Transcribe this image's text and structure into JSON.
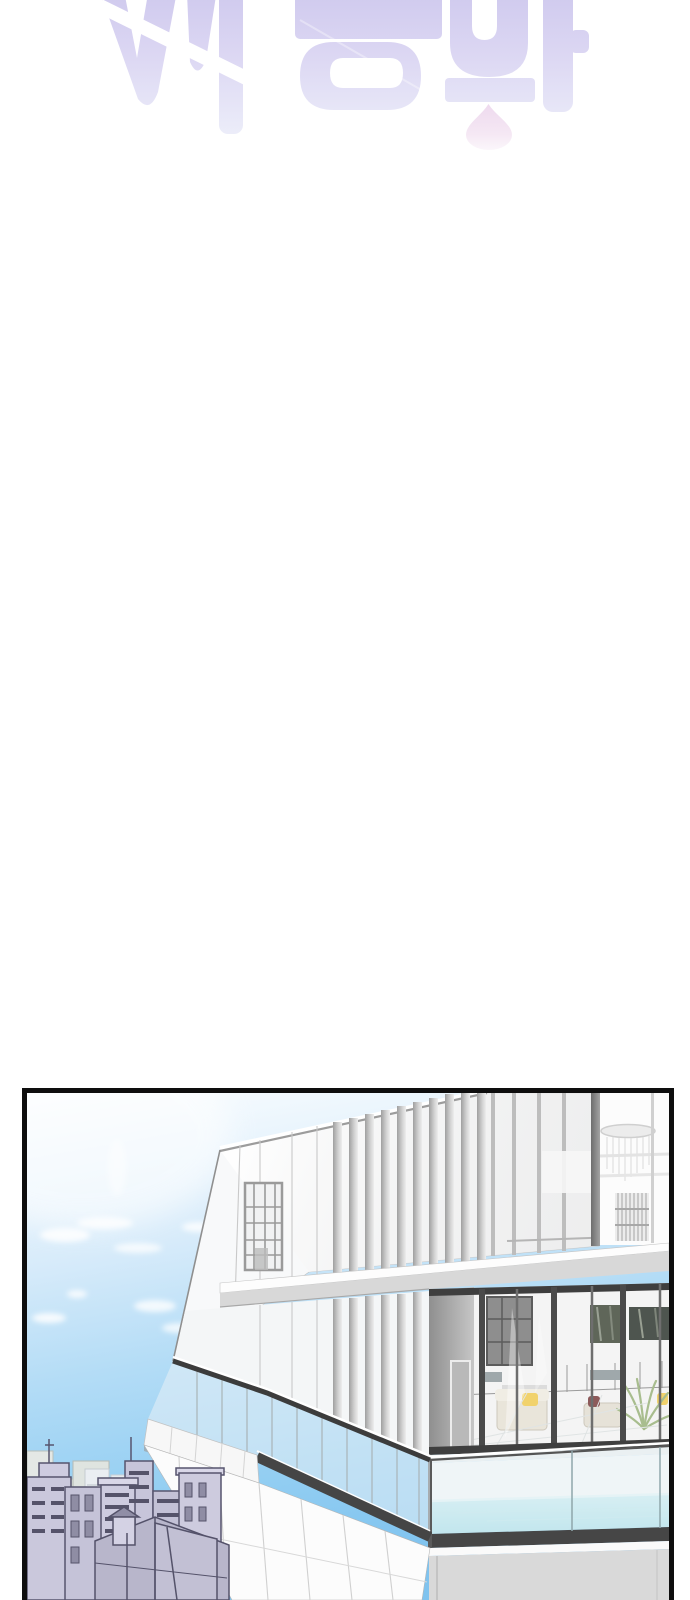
{
  "meta": {
    "canvas_width": 690,
    "canvas_height": 1600
  },
  "palette": {
    "page-bg": "#ffffff",
    "logo-top": "#cfc9ee",
    "logo-bottom": "#f1f4fb",
    "logo-slash": "#ffffff",
    "drop-pink": "#f0ddf0",
    "panel-border": "#0e0e0e",
    "sky-top": "#fafdff",
    "sky-mid": "#b3dcf6",
    "sky-bottom": "#7fc3ef",
    "cloud-white": "#ffffff",
    "facade-white": "#fbfbfb",
    "facade-gray": "#d9d9d9",
    "fascia-gray": "#d8d8d8",
    "mullion-dark": "#4a4a4a",
    "mullion-mid": "#9e9e9e",
    "mullion-light": "#c9c9c9",
    "rail-dark": "#3c3c3c",
    "glass-tint": "#e8f1f5",
    "pool-water-top": "#cdeef2",
    "pool-water-bottom": "#a3dde7",
    "pool-base-dark": "#464646",
    "interior-wall": "#f4f4f4",
    "sofa-cream": "#e9e5da",
    "cushion-yellow": "#f1d26c",
    "cushion-red": "#8d5a5a",
    "plant-green": "#a8bd8e",
    "art-olive": "#5f6659",
    "city-lavender": "#cac8dc",
    "city-outline": "#57556e",
    "city-roof": "#b8b6cb",
    "city-back": "#dfe4e0",
    "city-window": "#8f8da4"
  }
}
